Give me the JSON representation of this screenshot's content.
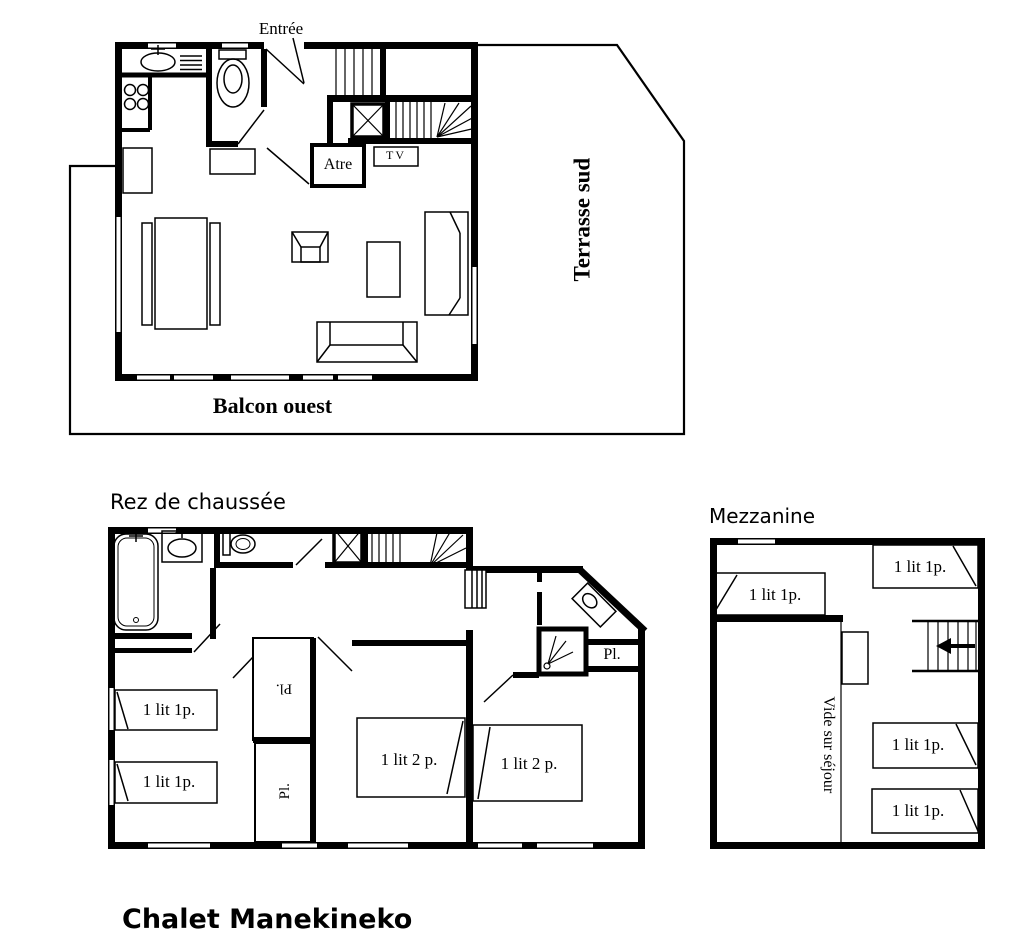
{
  "page_title": "Chalet Manekineko",
  "colors": {
    "ink": "#000000",
    "paper": "#ffffff"
  },
  "floor_upper": {
    "entrance_label": "Entrée",
    "fireplace_label": "Atre",
    "tv_label": "TV",
    "terrace_label": "Terrasse sud",
    "balcony_label": "Balcon ouest"
  },
  "floor_ground": {
    "title": "Rez de chaussée",
    "bed_single": "1 lit 1p.",
    "bed_double": "1 lit 2 p.",
    "closet_label": "Pl."
  },
  "floor_mezzanine": {
    "title": "Mezzanine",
    "bed_single": "1 lit 1p.",
    "void_label": "Vide sur séjour"
  }
}
